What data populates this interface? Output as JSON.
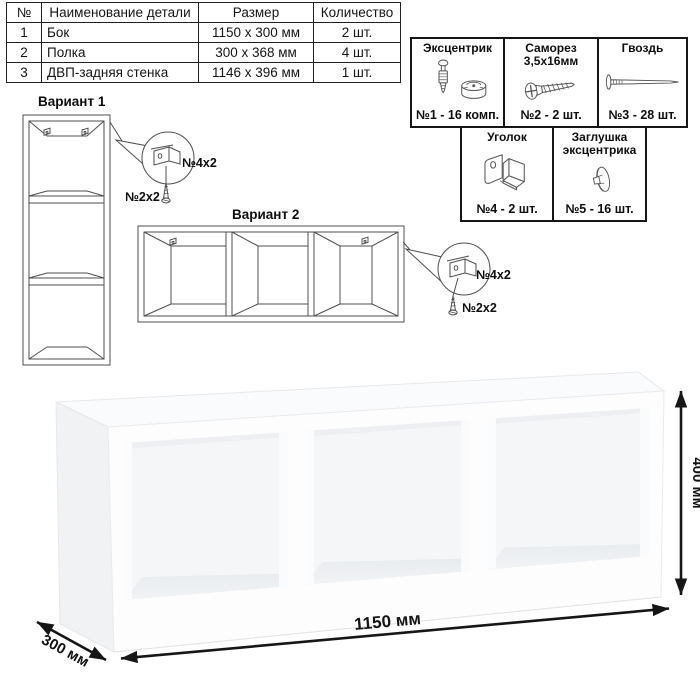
{
  "parts_table": {
    "headers": [
      "№",
      "Наименование детали",
      "Размер",
      "Количество"
    ],
    "rows": [
      {
        "num": "1",
        "name": "Бок",
        "size": "1150 x 300 мм",
        "qty": "2 шт."
      },
      {
        "num": "2",
        "name": "Полка",
        "size": "300 x 368 мм",
        "qty": "4 шт."
      },
      {
        "num": "3",
        "name": "ДВП-задняя стенка",
        "size": "1146 x 396 мм",
        "qty": "1 шт."
      }
    ]
  },
  "hardware": {
    "items": [
      {
        "title": "Эксцентрик",
        "label": "№1 - 16 комп.",
        "icon": "cam-lock-icon"
      },
      {
        "title": "Саморез 3,5х16мм",
        "label": "№2 - 2 шт.",
        "icon": "screw-icon"
      },
      {
        "title": "Гвоздь",
        "label": "№3 - 28 шт.",
        "icon": "nail-icon"
      },
      {
        "title": "Уголок",
        "label": "№4 - 2 шт.",
        "icon": "corner-bracket-icon"
      },
      {
        "title": "Заглушка эксцентрика",
        "label": "№5 - 16 шт.",
        "icon": "cam-cover-icon"
      }
    ]
  },
  "variants": {
    "v1": {
      "title": "Вариант 1",
      "bracket_label": "№4х2",
      "screw_label": "№2х2"
    },
    "v2": {
      "title": "Вариант 2",
      "bracket_label": "№4х2",
      "screw_label": "№2х2"
    }
  },
  "dimensions": {
    "width": "1150 мм",
    "height": "400 мм",
    "depth": "300 мм"
  },
  "colors": {
    "line": "#4f4f4f",
    "text": "#111111",
    "dimension": "#141414",
    "shelf_face": "#fdfdfe"
  }
}
